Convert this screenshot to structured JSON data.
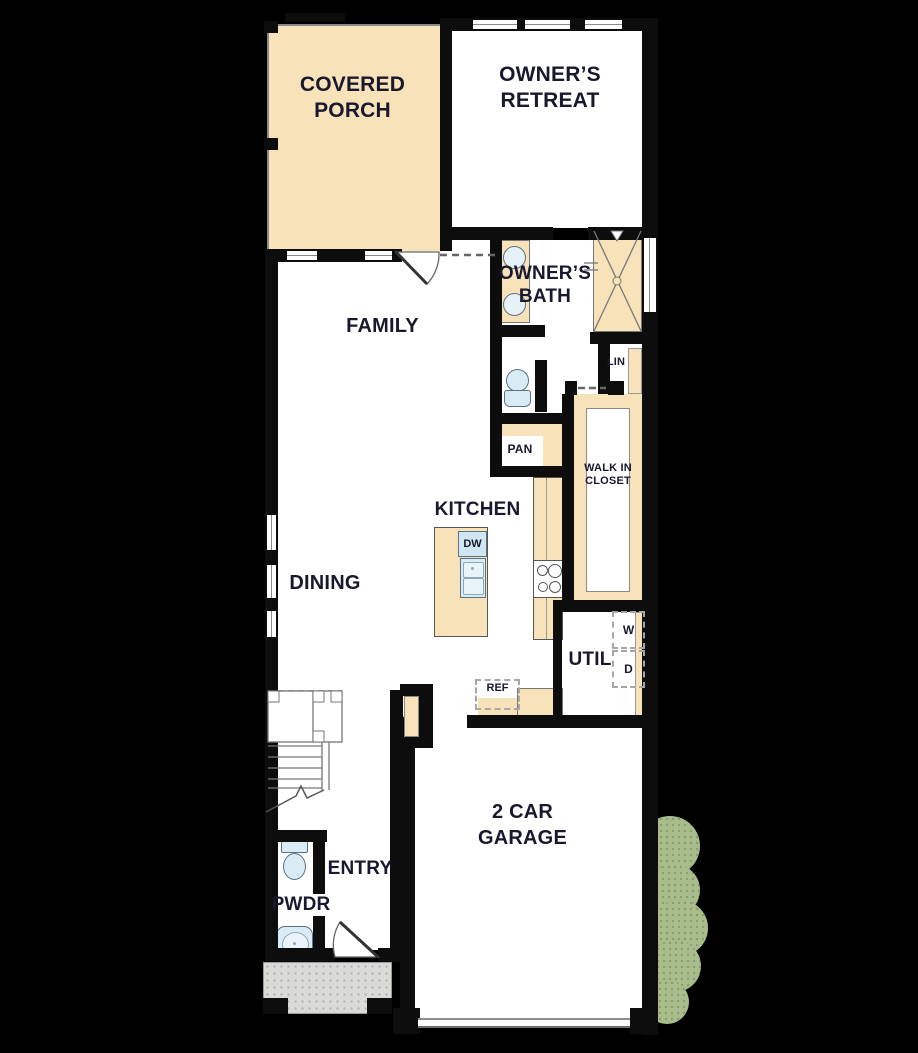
{
  "rooms": {
    "covered_porch": {
      "line1": "COVERED",
      "line2": "PORCH"
    },
    "owners_retreat": {
      "line1": "OWNER’S",
      "line2": "RETREAT"
    },
    "owners_bath": {
      "line1": "OWNER’S",
      "line2": "BATH"
    },
    "family": {
      "label": "FAMILY"
    },
    "dining": {
      "label": "DINING"
    },
    "kitchen": {
      "label": "KITCHEN"
    },
    "walk_in_closet": {
      "line1": "WALK IN",
      "line2": "CLOSET"
    },
    "util": {
      "label": "UTIL"
    },
    "entry": {
      "label": "ENTRY"
    },
    "pwdr": {
      "label": "PWDR"
    },
    "garage": {
      "line1": "2 CAR",
      "line2": "GARAGE"
    },
    "lin": {
      "label": "LIN"
    },
    "pan": {
      "label": "PAN"
    }
  },
  "fixtures": {
    "dishwasher": "DW",
    "refrigerator": "REF",
    "washer": "W",
    "dryer": "D"
  },
  "colors": {
    "background": "#000000",
    "floor": "#ffffff",
    "porch_tan": "#f7e2ba",
    "fixture_blue": "#d9ecf5",
    "bush_green": "#a9bd8c",
    "stoop_gray": "#dadad6",
    "wall_black": "#0d0d0d"
  }
}
